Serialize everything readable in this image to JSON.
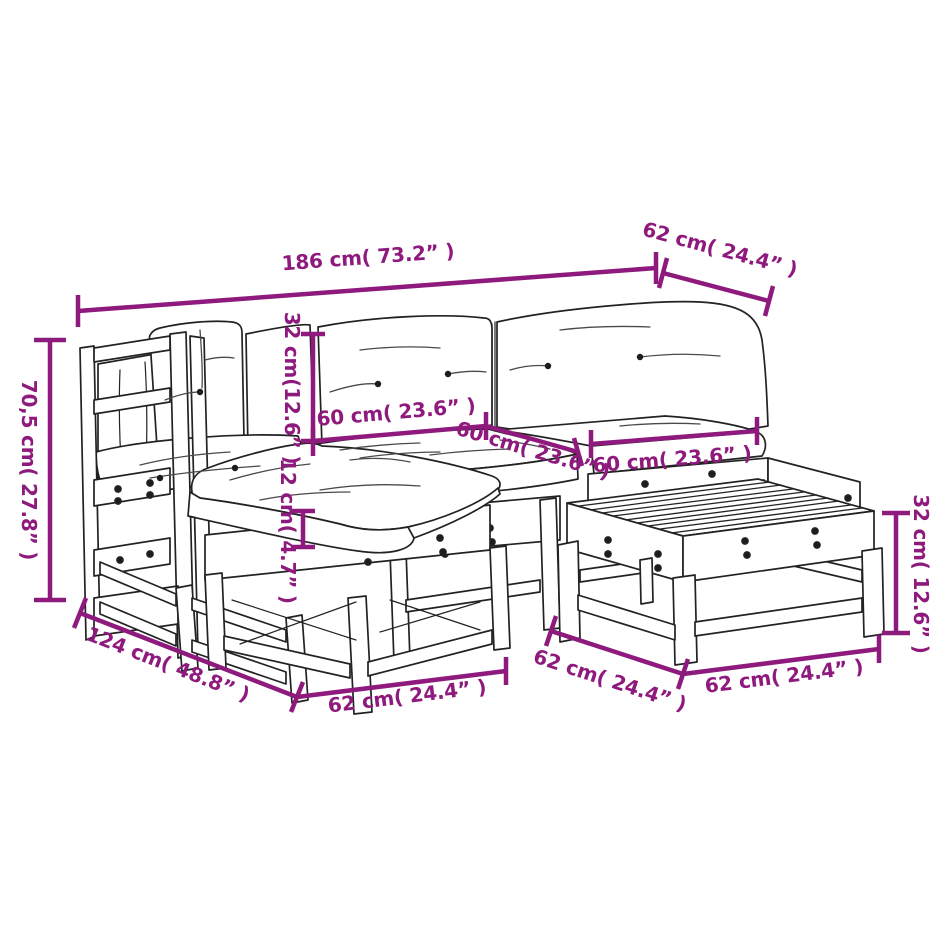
{
  "diagram": {
    "background": "#FFFFFF",
    "dimension_color": "#8E1A7D",
    "line_art_color": "#222222",
    "labels": {
      "total_width": "186 cm( 73.2” )",
      "module_depth_top": "62 cm( 24.4” )",
      "back_height": "70,5 cm( 27.8” )",
      "back_cushion_height": "32 cm(12.6” )",
      "seat_cushion_width_left": "60 cm( 23.6” )",
      "seat_cushion_depth": "60 cm( 23.6” )",
      "seat_cushion_width_right": "60 cm( 23.6” )",
      "seat_cushion_thickness": "12 cm( 4.7” )",
      "corner_depth": "124 cm( 48.8” )",
      "ottoman_width": "62 cm( 24.4” )",
      "table_depth": "62 cm( 24.4” )",
      "table_width": "62 cm( 24.4” )",
      "table_height": "32 cm( 12.6” )"
    }
  }
}
